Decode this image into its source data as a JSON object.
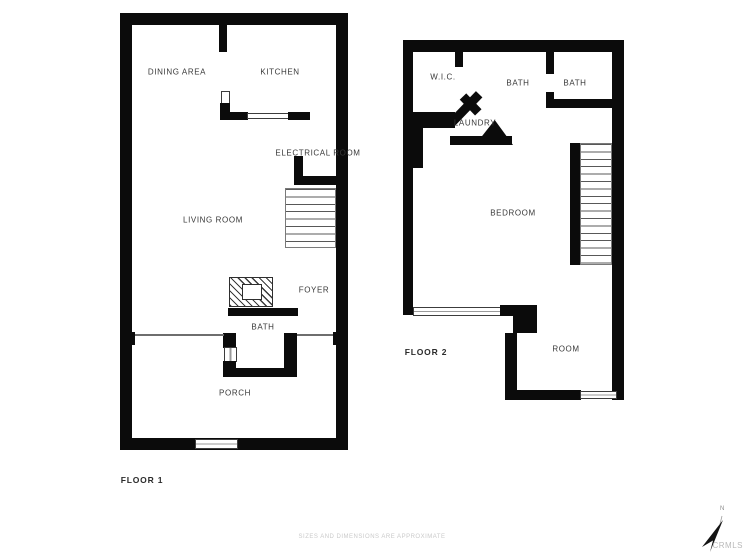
{
  "page": {
    "type": "floor-plan"
  },
  "floors": [
    {
      "name": "floor-1",
      "label": "FLOOR 1",
      "rooms": [
        {
          "label": "DINING AREA"
        },
        {
          "label": "KITCHEN"
        },
        {
          "label": "ELECTRICAL ROOM"
        },
        {
          "label": "LIVING ROOM"
        },
        {
          "label": "FOYER"
        },
        {
          "label": "BATH"
        },
        {
          "label": "PORCH"
        }
      ]
    },
    {
      "name": "floor-2",
      "label": "FLOOR 2",
      "rooms": [
        {
          "label": "W.I.C."
        },
        {
          "label": "BATH"
        },
        {
          "label": "BATH"
        },
        {
          "label": "LAUNDRY"
        },
        {
          "label": "BEDROOM"
        },
        {
          "label": "ROOM"
        }
      ]
    }
  ],
  "footer": {
    "disclaimer": "SIZES AND DIMENSIONS ARE APPROXIMATE"
  },
  "compass": {
    "north_label": "N"
  },
  "watermark": {
    "text": "CRMLS"
  },
  "colors": {
    "wall": "#0b0b0b",
    "label": "#383838",
    "muted": "#cacaca"
  }
}
